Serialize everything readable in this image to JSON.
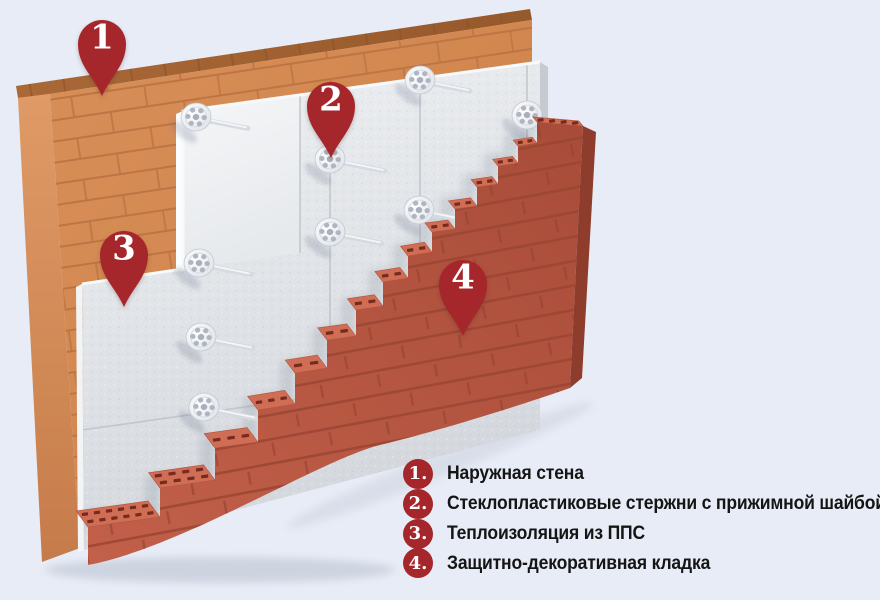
{
  "title": "Схема утепления наружной стены",
  "background_color": "#e8ecf6",
  "accent_red": "#a5262b",
  "wall_colors": {
    "inner_wall_orange": "#d5894f",
    "insulation_gray": "#e3e6e9",
    "cladding_red": "#b4543f",
    "fastener_white": "#eef1f4"
  },
  "markers": [
    {
      "number": "1"
    },
    {
      "number": "2"
    },
    {
      "number": "3"
    },
    {
      "number": "4"
    }
  ],
  "legend": {
    "items": [
      {
        "num": "1.",
        "label": "Наружная стена"
      },
      {
        "num": "2.",
        "label": "Стеклопластиковые стержни с прижимной шайбой"
      },
      {
        "num": "3.",
        "label": "Теплоизоляция из ППС"
      },
      {
        "num": "4.",
        "label": "Защитно-декоративная кладка"
      }
    ]
  }
}
